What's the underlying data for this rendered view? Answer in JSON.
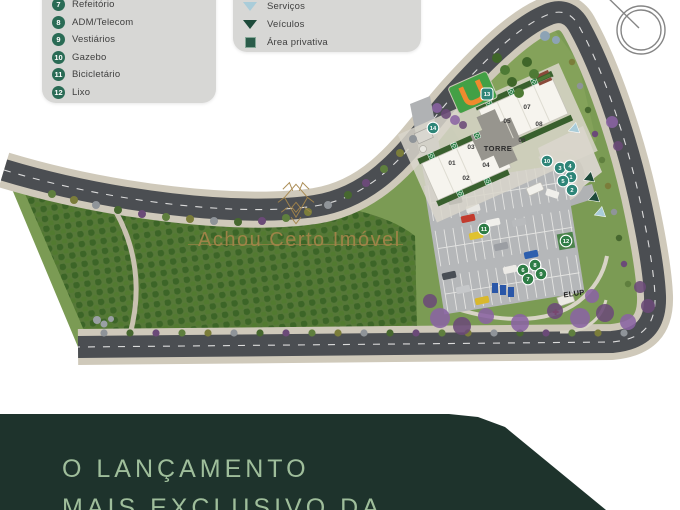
{
  "legend_numbered": {
    "items": [
      {
        "num": "7",
        "label": "Refeitório"
      },
      {
        "num": "8",
        "label": "ADM/Telecom"
      },
      {
        "num": "9",
        "label": "Vestiários"
      },
      {
        "num": "10",
        "label": "Gazebo"
      },
      {
        "num": "11",
        "label": "Bicicletário"
      },
      {
        "num": "12",
        "label": "Lixo"
      }
    ]
  },
  "legend_symbols": {
    "items": [
      {
        "icon": "triangle-down-light",
        "label": "Serviços"
      },
      {
        "icon": "triangle-down-dark",
        "label": "Veículos"
      },
      {
        "icon": "square-dark",
        "label": "Área privativa"
      }
    ]
  },
  "map": {
    "torre_label": "TORRE",
    "elup_label": "ELUP",
    "units": [
      {
        "label": "01",
        "x": 452,
        "y": 165
      },
      {
        "label": "02",
        "x": 466,
        "y": 180
      },
      {
        "label": "03",
        "x": 471,
        "y": 149
      },
      {
        "label": "04",
        "x": 486,
        "y": 167
      },
      {
        "label": "05",
        "x": 507,
        "y": 123
      },
      {
        "label": "06",
        "x": 522,
        "y": 142
      },
      {
        "label": "07",
        "x": 527,
        "y": 109
      },
      {
        "label": "08",
        "x": 539,
        "y": 126
      }
    ],
    "markers": [
      {
        "n": "1",
        "x": 571,
        "y": 177,
        "color": "teal"
      },
      {
        "n": "2",
        "x": 572,
        "y": 190,
        "color": "teal"
      },
      {
        "n": "3",
        "x": 560,
        "y": 168,
        "color": "teal"
      },
      {
        "n": "4",
        "x": 570,
        "y": 166,
        "color": "teal"
      },
      {
        "n": "5",
        "x": 563,
        "y": 181,
        "color": "teal"
      },
      {
        "n": "6",
        "x": 523,
        "y": 270,
        "color": "green"
      },
      {
        "n": "7",
        "x": 528,
        "y": 279,
        "color": "green"
      },
      {
        "n": "8",
        "x": 535,
        "y": 265,
        "color": "green"
      },
      {
        "n": "9",
        "x": 541,
        "y": 274,
        "color": "green"
      },
      {
        "n": "10",
        "x": 547,
        "y": 161,
        "color": "teal"
      },
      {
        "n": "11",
        "x": 484,
        "y": 229,
        "color": "green"
      },
      {
        "n": "12",
        "x": 566,
        "y": 241,
        "color": "green"
      },
      {
        "n": "13",
        "x": 487,
        "y": 94,
        "color": "teal",
        "shape": "square"
      },
      {
        "n": "14",
        "x": 433,
        "y": 128,
        "color": "teal"
      }
    ],
    "arrows": [
      {
        "type": "servicos",
        "x": 574,
        "y": 129,
        "angle": 250
      },
      {
        "type": "veiculos",
        "x": 589,
        "y": 178,
        "angle": 250
      },
      {
        "type": "veiculos",
        "x": 594,
        "y": 198,
        "angle": 250
      },
      {
        "type": "servicos",
        "x": 600,
        "y": 213,
        "angle": 250
      }
    ]
  },
  "watermark": {
    "text": "Achou Certo Imóvel"
  },
  "footer": {
    "line1": "O LANÇAMENTO",
    "line2": "MAIS EXCLUSIVO DA"
  },
  "colors": {
    "accent_teal": "#2e8578",
    "accent_green": "#2e7d46",
    "legend_circle": "#2a6b55",
    "servicos": "#a9ccd9",
    "veiculos": "#1d4a3a",
    "band": "#1e332c",
    "band_text": "#9fbe9b",
    "gold": "#a5854a"
  }
}
